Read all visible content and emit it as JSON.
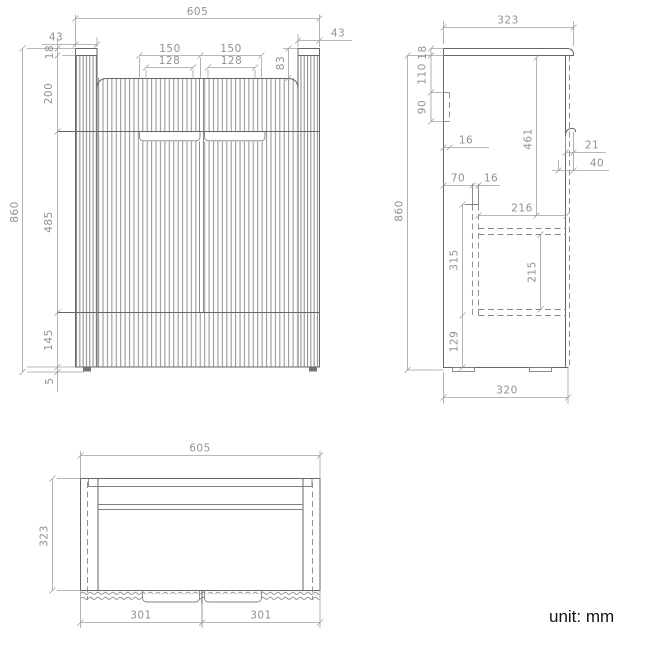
{
  "unit_label": "unit: mm",
  "colors": {
    "outline": "#63666a",
    "dimension_line": "#9ea1a4",
    "dimension_text": "#8f9296",
    "unit_text": "#141414",
    "background": "#ffffff"
  },
  "views": {
    "front": {
      "dims": {
        "overall_width": "605",
        "left_post": "43",
        "right_post": "43",
        "left_handle": "150",
        "right_handle": "150",
        "left_handle_inner": "128",
        "right_handle_inner": "128",
        "top_recess": "83",
        "top_thickness": "18",
        "upper_section": "200",
        "door_section": "485",
        "drawer_section": "145",
        "foot": "5",
        "overall_height": "860"
      }
    },
    "side": {
      "dims": {
        "top_depth": "323",
        "top_thickness": "18",
        "hanger_offset": "110",
        "hanger_height": "90",
        "hanger_depth": "16",
        "front_height": "461",
        "handle_lip": "21",
        "handle_recess": "40",
        "drawer_back_gap": "70",
        "panel_thickness": "16",
        "drawer_depth": "216",
        "drawer_zone": "315",
        "drawer_inner": "215",
        "base_zone": "129",
        "overall_height": "860",
        "body_depth": "320"
      }
    },
    "top": {
      "dims": {
        "overall_width": "605",
        "overall_depth": "323",
        "left_door": "301",
        "right_door": "301"
      }
    }
  }
}
